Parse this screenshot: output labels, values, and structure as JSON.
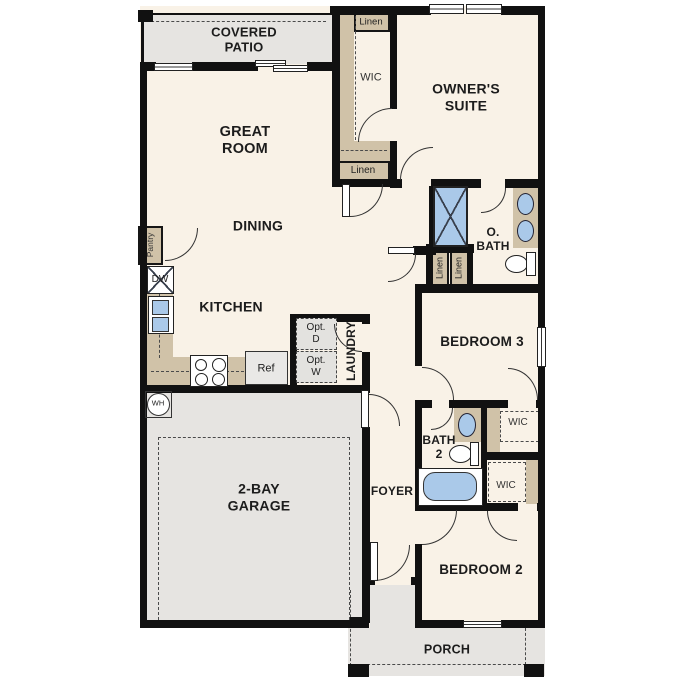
{
  "rooms": {
    "covered_patio": "COVERED\nPATIO",
    "great_room": "GREAT\nROOM",
    "dining": "DINING",
    "kitchen": "KITCHEN",
    "owners_suite": "OWNER'S\nSUITE",
    "owners_bath": "O.\nBATH",
    "bedroom_3": "BEDROOM 3",
    "bath_2": "BATH\n2",
    "bedroom_2": "BEDROOM 2",
    "foyer": "FOYER",
    "garage": "2-BAY\nGARAGE",
    "porch": "PORCH",
    "laundry": "LAUNDRY",
    "pantry": "Pantry"
  },
  "closets": {
    "wic_owners": "WIC",
    "linen_owners_wic": "Linen",
    "linen_hall": "Linen",
    "linen_bath_1": "Linen",
    "linen_bath_2": "Linen",
    "wic_bedroom_3": "WIC",
    "wic_bedroom_2": "WIC"
  },
  "appliances": {
    "dishwasher": "DW",
    "refrigerator": "Ref",
    "opt_dryer": "Opt.\nD",
    "opt_washer": "Opt.\nW",
    "water_heater": "WH"
  },
  "colors": {
    "wall": "#111111",
    "interior": "#f9f2e7",
    "outdoor": "#e6e4e1",
    "casework": "#d0c2a8",
    "water": "#aac9e9",
    "appliance": "#e9e8e6"
  }
}
